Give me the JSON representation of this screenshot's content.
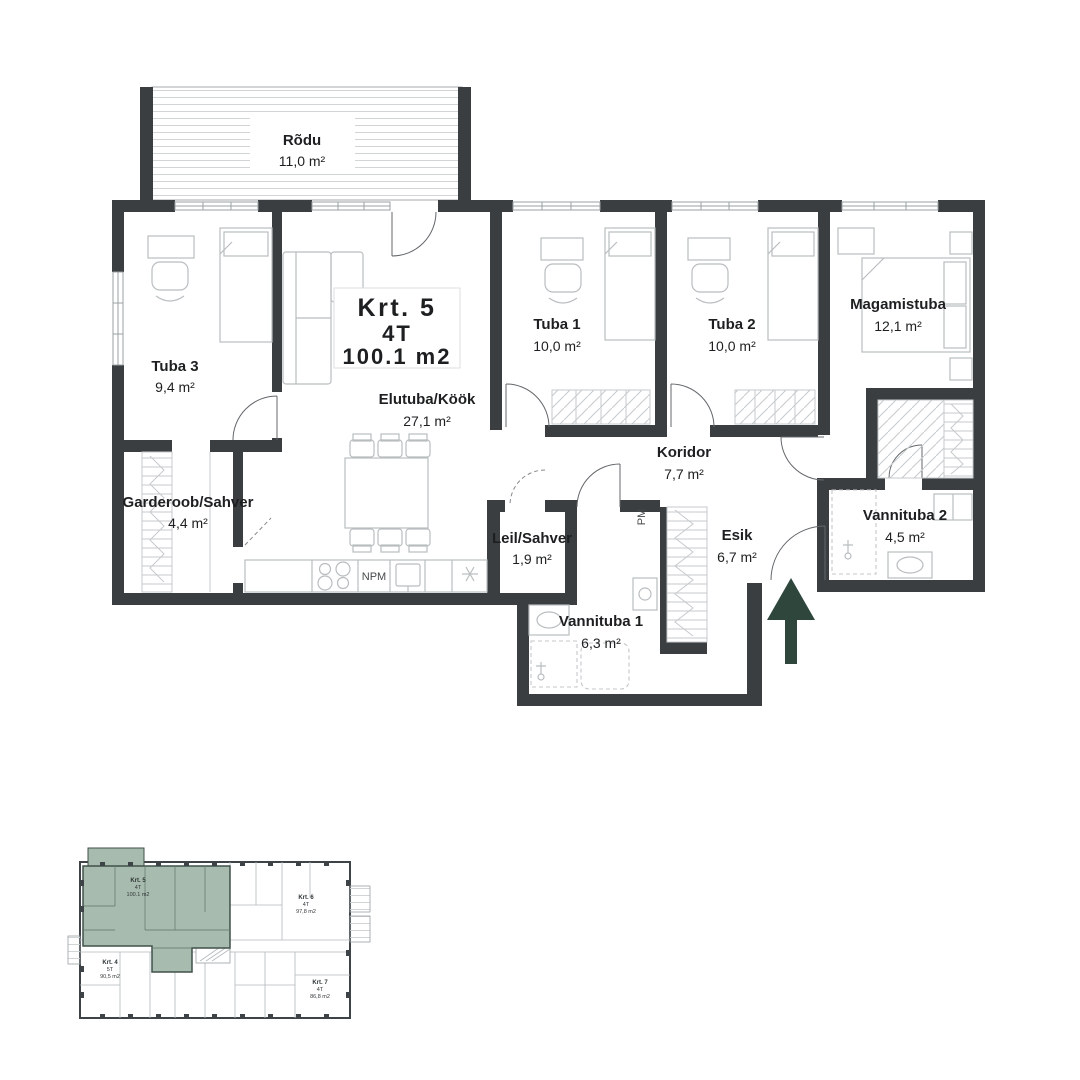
{
  "plan": {
    "title": {
      "line1": "Krt. 5",
      "line2": "4T",
      "line3": "100.1 m2"
    },
    "rooms": {
      "rodu": {
        "name": "Rõdu",
        "area": "11,0 m²"
      },
      "tuba3": {
        "name": "Tuba 3",
        "area": "9,4 m²"
      },
      "garderoob": {
        "name": "Garderoob/Sahver",
        "area": "4,4 m²"
      },
      "elutuba": {
        "name": "Elutuba/Köök",
        "area": "27,1 m²"
      },
      "tuba1": {
        "name": "Tuba 1",
        "area": "10,0 m²"
      },
      "tuba2": {
        "name": "Tuba 2",
        "area": "10,0 m²"
      },
      "magamistuba": {
        "name": "Magamistuba",
        "area": "12,1 m²"
      },
      "koridor": {
        "name": "Koridor",
        "area": "7,7 m²"
      },
      "esik": {
        "name": "Esik",
        "area": "6,7 m²"
      },
      "leil": {
        "name": "Leil/Sahver",
        "area": "1,9 m²"
      },
      "vannituba1": {
        "name": "Vannituba 1",
        "area": "6,3 m²"
      },
      "vannituba2": {
        "name": "Vannituba 2",
        "area": "4,5 m²"
      }
    },
    "markers": {
      "pm": "PM",
      "npm": "NPM"
    }
  },
  "minimap": {
    "units": [
      {
        "id": "krt5",
        "label": "Krt. 5",
        "type": "4T",
        "area": "100.1 m2",
        "highlighted": true
      },
      {
        "id": "krt6",
        "label": "Krt. 6",
        "type": "4T",
        "area": "97,8 m2",
        "highlighted": false
      },
      {
        "id": "krt4",
        "label": "Krt. 4",
        "type": "5T",
        "area": "90,5 m2",
        "highlighted": false
      },
      {
        "id": "krt7",
        "label": "Krt. 7",
        "type": "4T",
        "area": "86,8 m2",
        "highlighted": false
      }
    ]
  },
  "colors": {
    "wall": "#3a3e40",
    "furniture": "#b9bdbf",
    "hatch": "#c6cacc",
    "arrow_green": "#2f463d",
    "minimap_highlight": "#a7bbae",
    "text": "#1d1f20"
  }
}
